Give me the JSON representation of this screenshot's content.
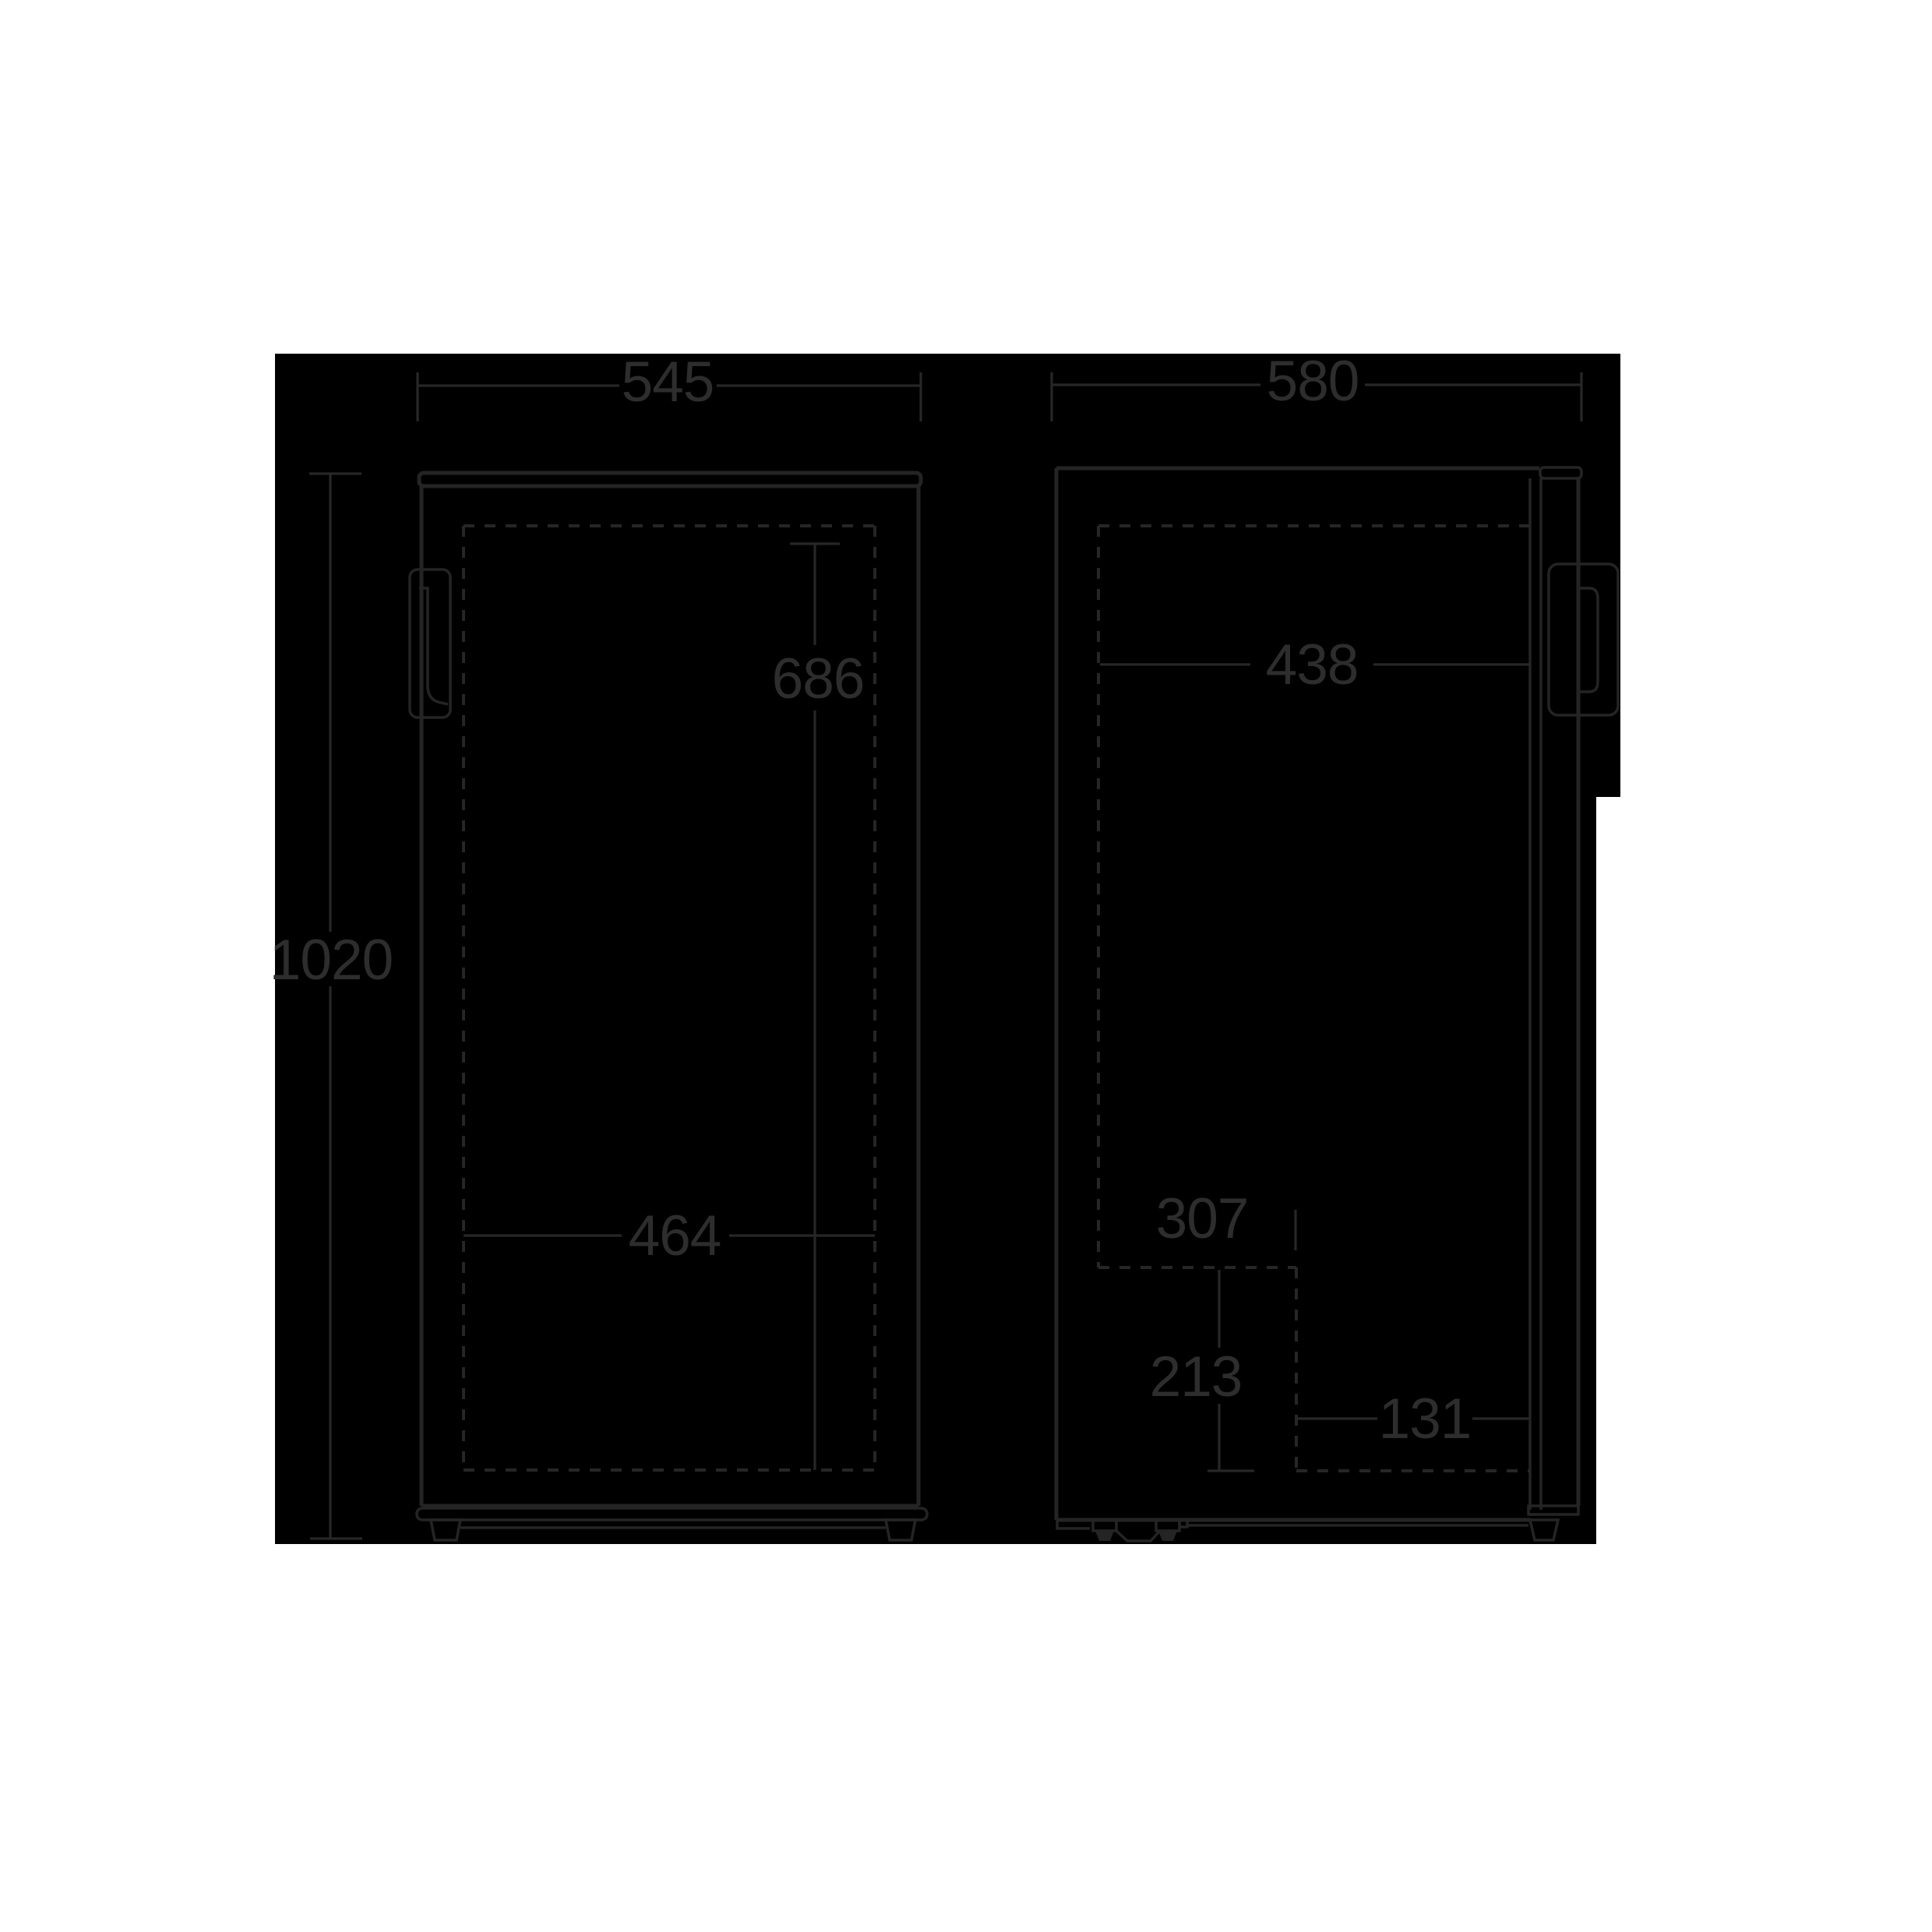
{
  "diagram": {
    "type": "appliance-dimension-drawing",
    "views": [
      "front-view",
      "side-view"
    ],
    "background_color": "#000000",
    "page_color": "#ffffff",
    "line_color": "#242424",
    "text_color": "#2d2d2d"
  },
  "front_view": {
    "width_label": "545",
    "height_label": "1020",
    "interior_height_label": "686",
    "interior_width_label": "464"
  },
  "side_view": {
    "depth_label": "580",
    "interior_depth_label": "438",
    "recess_depth_label": "307",
    "recess_height_label": "213",
    "recess_front_gap_label": "131"
  }
}
